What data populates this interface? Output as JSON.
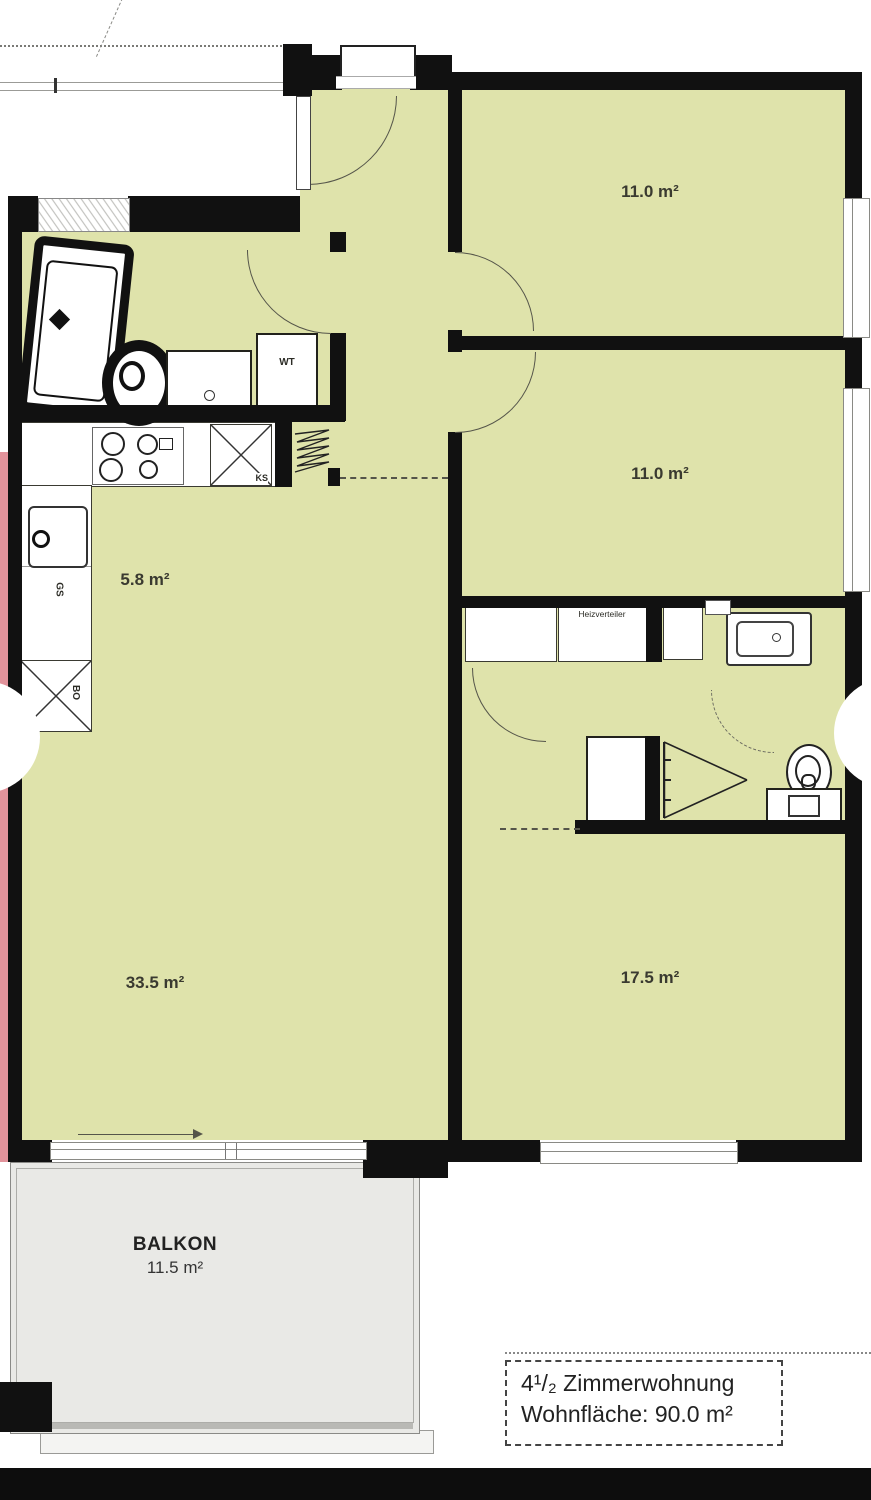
{
  "rooms": {
    "top_right": {
      "area": "11.0 m²"
    },
    "mid_right": {
      "area": "11.0 m²"
    },
    "kitchen": {
      "area": "5.8 m²"
    },
    "living": {
      "area": "33.5 m²"
    },
    "bedroom": {
      "area": "17.5 m²"
    }
  },
  "balcony": {
    "name": "BALKON",
    "area": "11.5 m²"
  },
  "info_box": {
    "line1": "4¹/₂ Zimmerwohnung",
    "line2": "Wohnfläche: 90.0 m²"
  },
  "fixture_labels": {
    "heating_manifold": "Heizverteiler",
    "washbasin": "WT",
    "fridge": "KS",
    "dishwasher": "GS",
    "oven": "BO"
  },
  "colors": {
    "room_fill": "#dfe3ab",
    "wall": "#111111",
    "pink_strip": "#e2939b",
    "balcony_fill": "#e9e9e6",
    "bottom_bar": "#0d0d0d"
  }
}
